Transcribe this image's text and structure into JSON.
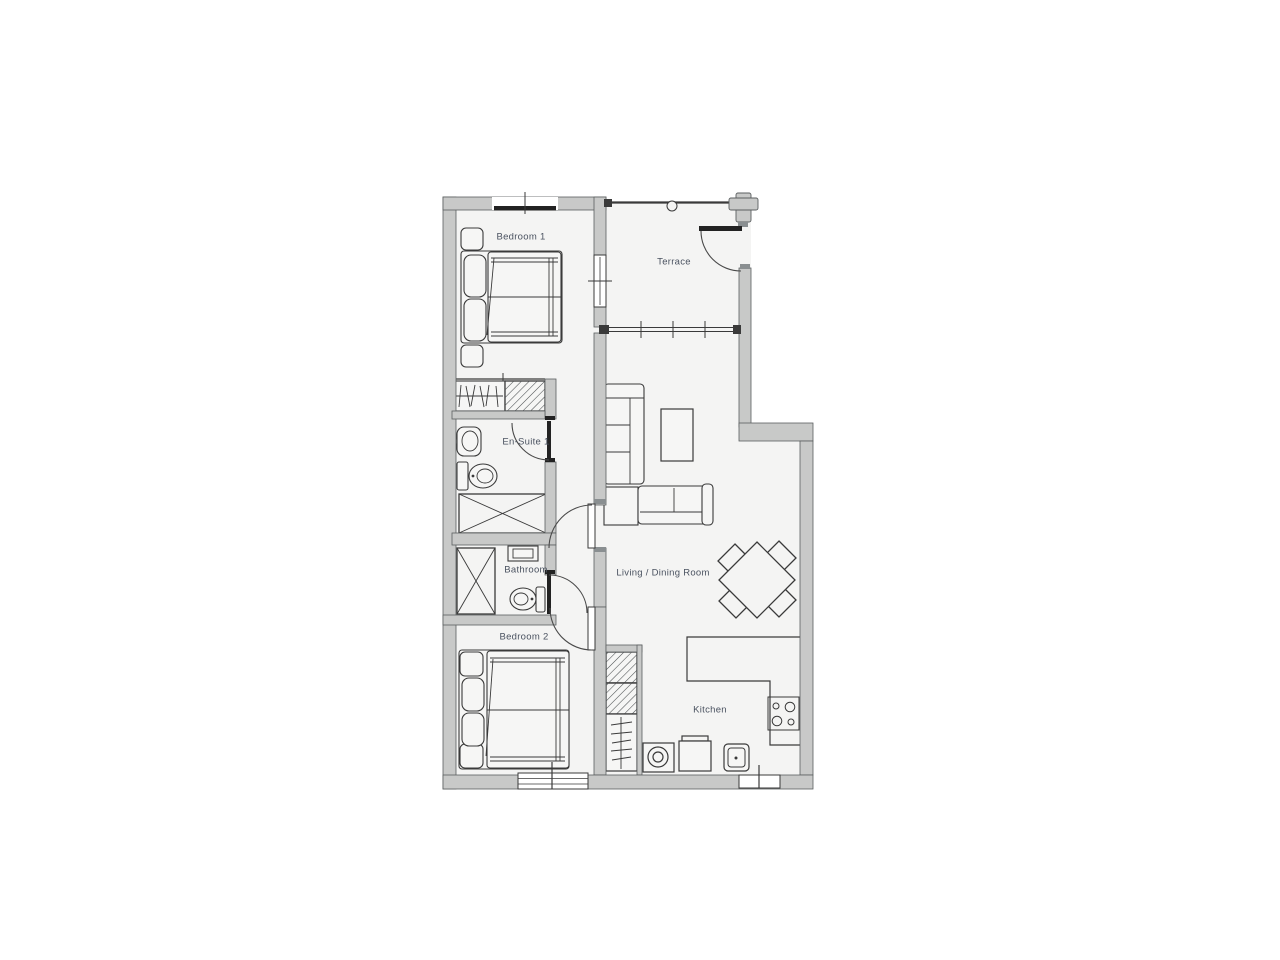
{
  "title": "Two bedroom apartment floor plan",
  "colors": {
    "background": "#ffffff",
    "floor": "#f4f4f3",
    "wall_fill": "#c8c9c8",
    "wall_stroke": "#5b5f60",
    "line": "#3a3a3a",
    "label_text": "#4a5260"
  },
  "rooms": {
    "bedroom1": {
      "label": "Bedroom 1"
    },
    "terrace": {
      "label": "Terrace"
    },
    "ensuite1": {
      "label": "En-Suite 1"
    },
    "bathroom": {
      "label": "Bathroom"
    },
    "bedroom2": {
      "label": "Bedroom 2"
    },
    "living_dining": {
      "label": "Living / Dining Room"
    },
    "kitchen": {
      "label": "Kitchen"
    }
  },
  "fixtures": [
    "double-bed",
    "bedside-table",
    "wardrobe",
    "shower",
    "bath",
    "wash-basin",
    "toilet",
    "corner-sofa",
    "coffee-table",
    "dining-table",
    "dining-chair",
    "kitchen-counter",
    "hob",
    "oven",
    "washing-machine",
    "kitchen-sink",
    "storage-cupboard",
    "terrace-railing",
    "column",
    "window",
    "door"
  ]
}
